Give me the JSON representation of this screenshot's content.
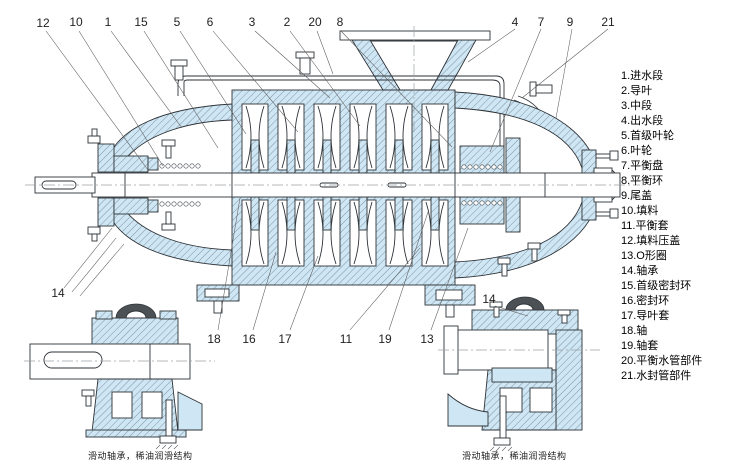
{
  "diagram": {
    "title": "multistage-centrifugal-pump-sectional-drawing",
    "legend": {
      "items": [
        "1.进水段",
        "2.导叶",
        "3.中段",
        "4.出水段",
        "5.首级叶轮",
        "6.叶轮",
        "7.平衡盘",
        "8.平衡环",
        "9.尾盖",
        "10.填料",
        "11.平衡套",
        "12.填料压盖",
        "13.O形圈",
        "14.轴承",
        "15.首级密封环",
        "16.密封环",
        "17.导叶套",
        "18.轴",
        "19.轴套",
        "20.平衡水管部件",
        "21.水封管部件"
      ]
    },
    "callouts": {
      "top": [
        "12",
        "10",
        "1",
        "15",
        "5",
        "6",
        "3",
        "2",
        "20",
        "8",
        "4",
        "7",
        "9",
        "21"
      ],
      "bottom": [
        "14",
        "18",
        "16",
        "17",
        "11",
        "19",
        "13",
        "14"
      ]
    },
    "captions": {
      "left": "滑动轴承，稀油润滑结构",
      "right": "滑动轴承，稀油润滑结构"
    },
    "colors": {
      "section_fill": "#cfe6f4",
      "outline": "#2e3338",
      "hatch_line": "#6b7f8d",
      "leader": "#5a5a5a"
    }
  }
}
